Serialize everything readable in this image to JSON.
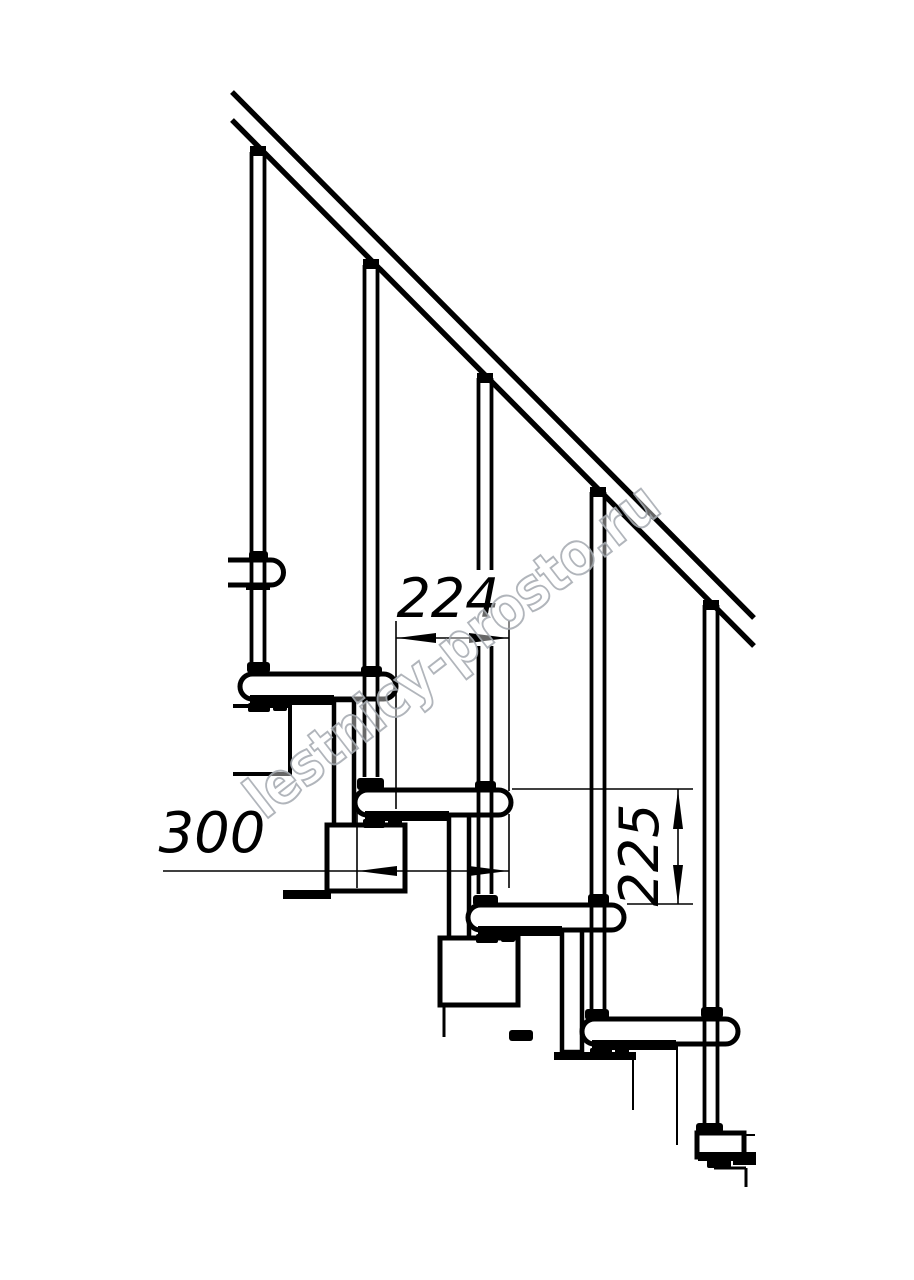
{
  "meta": {
    "background": "#ffffff",
    "ink": "#000000",
    "watermark_fill": "rgba(255,255,255,0.45)",
    "watermark_stroke": "#a9aeb4",
    "description": "Side-view technical drawing of a modular staircase with handrail, balusters, treads and dimension callouts"
  },
  "labels": {
    "dim_going": "224",
    "dim_depth": "300",
    "dim_rise": "225",
    "watermark": "lestnicy-prosto.ru"
  },
  "drawing": {
    "width": 914,
    "height": 1280,
    "primitives": [
      {
        "t": "rect",
        "n": "module-column-2",
        "x": 334,
        "y": 700,
        "w": 20,
        "h": 126,
        "s": 4.5,
        "f": "#fff"
      },
      {
        "t": "rect",
        "n": "module-column-3",
        "x": 449,
        "y": 814,
        "w": 20,
        "h": 125,
        "s": 4.5,
        "f": "#fff"
      },
      {
        "t": "rect",
        "n": "module-column-4",
        "x": 562,
        "y": 929,
        "w": 20,
        "h": 123,
        "s": 4.5,
        "f": "#fff"
      },
      {
        "t": "line",
        "n": "module-column-5-edge",
        "x1": 677,
        "y1": 1045,
        "x2": 677,
        "y2": 1145,
        "s": 2
      },
      {
        "t": "path",
        "n": "module-box-2",
        "d": "M233,706 H290 V774 H233",
        "s": 4,
        "f": "#fff"
      },
      {
        "t": "rect",
        "n": "module-box-3",
        "x": 327,
        "y": 825,
        "w": 78,
        "h": 66,
        "s": 5,
        "f": "#fff"
      },
      {
        "t": "rect",
        "n": "module-box-3-flange",
        "x": 283,
        "y": 890,
        "w": 48,
        "h": 9,
        "f": "#000"
      },
      {
        "t": "rect",
        "n": "module-box-4",
        "x": 440,
        "y": 938,
        "w": 78,
        "h": 67,
        "s": 5,
        "f": "#fff"
      },
      {
        "t": "line",
        "n": "module-box-4-descender",
        "x1": 444,
        "y1": 1005,
        "x2": 444,
        "y2": 1037,
        "s": 3
      },
      {
        "t": "rect",
        "n": "module-box-4-foot",
        "x": 509,
        "y": 1030,
        "w": 24,
        "h": 11,
        "rx": 3,
        "f": "#000"
      },
      {
        "t": "rect",
        "n": "module-box-5-top",
        "x": 554,
        "y": 1052,
        "w": 82,
        "h": 8,
        "f": "#000"
      },
      {
        "t": "line",
        "n": "module-box-5-edge",
        "x1": 633,
        "y1": 1060,
        "x2": 633,
        "y2": 1110,
        "s": 2
      },
      {
        "t": "line",
        "n": "floor-connector-h",
        "x1": 714,
        "y1": 1168,
        "x2": 746,
        "y2": 1168,
        "s": 3
      },
      {
        "t": "line",
        "n": "floor-connector-v",
        "x1": 746,
        "y1": 1168,
        "x2": 746,
        "y2": 1187,
        "s": 3
      },
      {
        "t": "path",
        "n": "tread-1-partial",
        "d": "M228,560 h43 a12.5,12.5 0 0 1 0,25 h-43",
        "s": 5,
        "f": "#fff"
      },
      {
        "t": "rect",
        "n": "tread-2",
        "x": 240,
        "y": 674,
        "w": 156,
        "h": 25,
        "rx": 12.5,
        "s": 5,
        "f": "#fff"
      },
      {
        "t": "rect",
        "n": "tread-3",
        "x": 355,
        "y": 790,
        "w": 156,
        "h": 25,
        "rx": 12.5,
        "s": 5,
        "f": "#fff"
      },
      {
        "t": "rect",
        "n": "tread-4",
        "x": 468,
        "y": 905,
        "w": 156,
        "h": 25,
        "rx": 12.5,
        "s": 5,
        "f": "#fff"
      },
      {
        "t": "rect",
        "n": "tread-5",
        "x": 582,
        "y": 1019,
        "w": 156,
        "h": 25,
        "rx": 12.5,
        "s": 5,
        "f": "#fff"
      },
      {
        "t": "rect",
        "n": "tread-6-partial",
        "x": 697,
        "y": 1133,
        "w": 47,
        "h": 24,
        "s": 5,
        "f": "#fff"
      },
      {
        "t": "line",
        "n": "tread-6-edge-ext",
        "x1": 744,
        "y1": 1135,
        "x2": 755,
        "y2": 1135,
        "s": 2
      },
      {
        "t": "rect",
        "n": "tread-1-mount",
        "x": 246,
        "y": 583,
        "w": 24,
        "h": 7,
        "f": "#000"
      },
      {
        "t": "rect",
        "n": "tread-2-underside",
        "x": 250,
        "y": 695,
        "w": 84,
        "h": 10,
        "f": "#000"
      },
      {
        "t": "rect",
        "n": "tread-2-mount-a",
        "x": 248,
        "y": 703,
        "w": 22,
        "h": 9,
        "rx": 2,
        "f": "#000"
      },
      {
        "t": "rect",
        "n": "tread-2-mount-b",
        "x": 273,
        "y": 703,
        "w": 14,
        "h": 8,
        "rx": 2,
        "f": "#000"
      },
      {
        "t": "rect",
        "n": "tread-3-underside",
        "x": 365,
        "y": 811,
        "w": 84,
        "h": 10,
        "f": "#000"
      },
      {
        "t": "rect",
        "n": "tread-3-mount-a",
        "x": 363,
        "y": 819,
        "w": 22,
        "h": 9,
        "rx": 2,
        "f": "#000"
      },
      {
        "t": "rect",
        "n": "tread-3-mount-b",
        "x": 388,
        "y": 819,
        "w": 14,
        "h": 8,
        "rx": 2,
        "f": "#000"
      },
      {
        "t": "rect",
        "n": "tread-4-underside",
        "x": 478,
        "y": 926,
        "w": 84,
        "h": 10,
        "f": "#000"
      },
      {
        "t": "rect",
        "n": "tread-4-mount-a",
        "x": 476,
        "y": 934,
        "w": 22,
        "h": 9,
        "rx": 2,
        "f": "#000"
      },
      {
        "t": "rect",
        "n": "tread-4-mount-b",
        "x": 501,
        "y": 934,
        "w": 14,
        "h": 8,
        "rx": 2,
        "f": "#000"
      },
      {
        "t": "rect",
        "n": "tread-5-underside",
        "x": 592,
        "y": 1040,
        "w": 84,
        "h": 10,
        "f": "#000"
      },
      {
        "t": "rect",
        "n": "tread-5-mount-a",
        "x": 590,
        "y": 1048,
        "w": 22,
        "h": 9,
        "rx": 2,
        "f": "#000"
      },
      {
        "t": "rect",
        "n": "tread-5-mount-b",
        "x": 615,
        "y": 1048,
        "w": 14,
        "h": 8,
        "rx": 2,
        "f": "#000"
      },
      {
        "t": "rect",
        "n": "tread-6-underside",
        "x": 698,
        "y": 1152,
        "w": 58,
        "h": 9,
        "f": "#000"
      },
      {
        "t": "rect",
        "n": "tread-6-underside-b",
        "x": 733,
        "y": 1152,
        "w": 23,
        "h": 13,
        "f": "#000"
      },
      {
        "t": "rect",
        "n": "tread-6-mount",
        "x": 707,
        "y": 1159,
        "w": 24,
        "h": 9,
        "rx": 2,
        "f": "#000"
      },
      {
        "t": "line",
        "n": "handrail-top-edge",
        "x1": 232,
        "y1": 92,
        "x2": 754,
        "y2": 618,
        "s": 5.4
      },
      {
        "t": "line",
        "n": "handrail-bottom-edge",
        "x1": 232,
        "y1": 120,
        "x2": 754,
        "y2": 646,
        "s": 5.4
      },
      {
        "t": "rect",
        "n": "baluster-1-cap",
        "x": 250,
        "y": 146,
        "w": 16,
        "h": 10,
        "f": "#000"
      },
      {
        "t": "line",
        "n": "baluster-1-left",
        "x1": 251.5,
        "y1": 152,
        "x2": 251.5,
        "y2": 662,
        "s": 3.8
      },
      {
        "t": "line",
        "n": "baluster-1-right",
        "x1": 264.5,
        "y1": 152,
        "x2": 264.5,
        "y2": 662,
        "s": 3.8
      },
      {
        "t": "rect",
        "n": "baluster-1-collar",
        "x": 249,
        "y": 551,
        "w": 19,
        "h": 10,
        "rx": 3,
        "f": "#000"
      },
      {
        "t": "rect",
        "n": "baluster-1-foot",
        "x": 247,
        "y": 662,
        "w": 23,
        "h": 11,
        "rx": 3,
        "f": "#000"
      },
      {
        "t": "rect",
        "n": "baluster-2-cap",
        "x": 363,
        "y": 259,
        "w": 16,
        "h": 10,
        "f": "#000"
      },
      {
        "t": "line",
        "n": "baluster-2-left",
        "x1": 364.5,
        "y1": 265,
        "x2": 364.5,
        "y2": 777,
        "s": 3.8
      },
      {
        "t": "line",
        "n": "baluster-2-right",
        "x1": 377.5,
        "y1": 265,
        "x2": 377.5,
        "y2": 777,
        "s": 3.8
      },
      {
        "t": "rect",
        "n": "baluster-2-collar",
        "x": 361,
        "y": 666,
        "w": 21,
        "h": 11,
        "rx": 3,
        "f": "#000"
      },
      {
        "t": "rect",
        "n": "baluster-2-foot",
        "x": 357,
        "y": 778,
        "w": 27,
        "h": 12,
        "rx": 3,
        "f": "#000"
      },
      {
        "t": "rect",
        "n": "baluster-3-cap",
        "x": 477,
        "y": 373,
        "w": 16,
        "h": 10,
        "f": "#000"
      },
      {
        "t": "line",
        "n": "baluster-3-left-upper",
        "x1": 478.5,
        "y1": 378,
        "x2": 478.5,
        "y2": 572,
        "s": 3.8
      },
      {
        "t": "line",
        "n": "baluster-3-right-upper",
        "x1": 491.5,
        "y1": 378,
        "x2": 491.5,
        "y2": 572,
        "s": 3.8
      },
      {
        "t": "line",
        "n": "baluster-3-left-lower",
        "x1": 478.5,
        "y1": 646,
        "x2": 478.5,
        "y2": 894,
        "s": 3.8
      },
      {
        "t": "line",
        "n": "baluster-3-right-lower",
        "x1": 491.5,
        "y1": 646,
        "x2": 491.5,
        "y2": 894,
        "s": 3.8
      },
      {
        "t": "rect",
        "n": "baluster-3-collar",
        "x": 475,
        "y": 781,
        "w": 21,
        "h": 10,
        "rx": 3,
        "f": "#000"
      },
      {
        "t": "rect",
        "n": "baluster-3-foot",
        "x": 473,
        "y": 895,
        "w": 25,
        "h": 11,
        "rx": 3,
        "f": "#000"
      },
      {
        "t": "rect",
        "n": "baluster-4-cap",
        "x": 590,
        "y": 487,
        "w": 16,
        "h": 10,
        "f": "#000"
      },
      {
        "t": "line",
        "n": "baluster-4-left",
        "x1": 591.5,
        "y1": 492,
        "x2": 591.5,
        "y2": 1009,
        "s": 3.8
      },
      {
        "t": "line",
        "n": "baluster-4-right",
        "x1": 604.5,
        "y1": 492,
        "x2": 604.5,
        "y2": 1009,
        "s": 3.8
      },
      {
        "t": "rect",
        "n": "baluster-4-collar",
        "x": 588,
        "y": 894,
        "w": 21,
        "h": 11,
        "rx": 3,
        "f": "#000"
      },
      {
        "t": "rect",
        "n": "baluster-4-foot",
        "x": 585,
        "y": 1009,
        "w": 24,
        "h": 11,
        "rx": 3,
        "f": "#000"
      },
      {
        "t": "rect",
        "n": "baluster-5-cap",
        "x": 703,
        "y": 600,
        "w": 16,
        "h": 10,
        "f": "#000"
      },
      {
        "t": "line",
        "n": "baluster-5-left",
        "x1": 704.5,
        "y1": 605,
        "x2": 704.5,
        "y2": 1123,
        "s": 3.8
      },
      {
        "t": "line",
        "n": "baluster-5-right",
        "x1": 717.5,
        "y1": 605,
        "x2": 717.5,
        "y2": 1123,
        "s": 3.8
      },
      {
        "t": "rect",
        "n": "baluster-5-collar",
        "x": 701,
        "y": 1007,
        "w": 22,
        "h": 11,
        "rx": 3,
        "f": "#000"
      },
      {
        "t": "rect",
        "n": "baluster-5-foot",
        "x": 696,
        "y": 1123,
        "w": 27,
        "h": 10,
        "rx": 3,
        "f": "#000"
      },
      {
        "t": "rect",
        "n": "dim-going-text-mask",
        "x": 403,
        "y": 570,
        "w": 95,
        "h": 52,
        "f": "#fff"
      },
      {
        "t": "rect",
        "n": "dim-depth-text-mask",
        "x": 168,
        "y": 804,
        "w": 92,
        "h": 54,
        "f": "#fff"
      },
      {
        "t": "rect",
        "n": "dim-rise-text-mask",
        "x": 610,
        "y": 804,
        "w": 56,
        "h": 96,
        "f": "#fff"
      },
      {
        "t": "line",
        "n": "ext-line-going-left",
        "x1": 396,
        "y1": 621,
        "x2": 396,
        "y2": 809,
        "s": 1.6
      },
      {
        "t": "line",
        "n": "ext-line-going-right-upper",
        "x1": 509,
        "y1": 621,
        "x2": 509,
        "y2": 791,
        "s": 1.6
      },
      {
        "t": "line",
        "n": "ext-line-going-right-lower",
        "x1": 509,
        "y1": 814,
        "x2": 509,
        "y2": 888,
        "s": 1.6
      },
      {
        "t": "line",
        "n": "ext-line-depth-left",
        "x1": 357,
        "y1": 812,
        "x2": 357,
        "y2": 888,
        "s": 1.6
      },
      {
        "t": "line",
        "n": "ext-line-rise-top",
        "x1": 512,
        "y1": 789,
        "x2": 693,
        "y2": 789,
        "s": 1.6
      },
      {
        "t": "line",
        "n": "ext-line-rise-bottom",
        "x1": 627,
        "y1": 904,
        "x2": 693,
        "y2": 904,
        "s": 1.6
      },
      {
        "t": "line",
        "n": "dim-line-going",
        "x1": 396,
        "y1": 638,
        "x2": 509,
        "y2": 638,
        "s": 1.6
      },
      {
        "t": "line",
        "n": "dim-line-depth",
        "x1": 163,
        "y1": 871,
        "x2": 509,
        "y2": 871,
        "s": 1.6
      },
      {
        "t": "line",
        "n": "dim-line-rise",
        "x1": 678,
        "y1": 789,
        "x2": 678,
        "y2": 904,
        "s": 1.6
      },
      {
        "t": "poly",
        "n": "arrow-going-left",
        "pts": "397,638 436,633 436,643",
        "f": "#000"
      },
      {
        "t": "poly",
        "n": "arrow-going-right",
        "pts": "508,638 469,633 469,643",
        "f": "#000"
      },
      {
        "t": "poly",
        "n": "arrow-depth-left",
        "pts": "358,871 397,866 397,876",
        "f": "#000"
      },
      {
        "t": "poly",
        "n": "arrow-depth-right",
        "pts": "508,871 469,866 469,876",
        "f": "#000"
      },
      {
        "t": "poly",
        "n": "arrow-rise-top",
        "pts": "678,790 673,829 683,829",
        "f": "#000"
      },
      {
        "t": "poly",
        "n": "arrow-rise-bottom",
        "pts": "678,904 673,865 683,865",
        "f": "#000"
      },
      {
        "t": "text",
        "n": "dim-going-label",
        "x": 448,
        "y": 617,
        "fs": 54,
        "italic": true,
        "anchor": "middle",
        "fillc": "#000",
        "ref": "@dim_going"
      },
      {
        "t": "text",
        "n": "dim-depth-label",
        "x": 212,
        "y": 852,
        "fs": 56,
        "italic": true,
        "anchor": "middle",
        "fillc": "#000",
        "ref": "@dim_depth"
      },
      {
        "t": "text",
        "n": "dim-rise-label",
        "x": 640,
        "y": 873,
        "fs": 54,
        "italic": true,
        "anchor": "middle",
        "fillc": "#000",
        "rot": "rotate(-90 640 855)",
        "ref": "@dim_rise"
      },
      {
        "t": "text",
        "n": "watermark",
        "x": 0,
        "y": 20,
        "fs": 58,
        "bold": true,
        "anchor": "middle",
        "fillc": "rgba(255,255,255,0.45)",
        "stroke": "#a9aeb4",
        "sw": 2,
        "tl": 505,
        "tr": "translate(452,650) rotate(-37.8)",
        "op": 0.9,
        "ref": "@watermark"
      }
    ]
  }
}
